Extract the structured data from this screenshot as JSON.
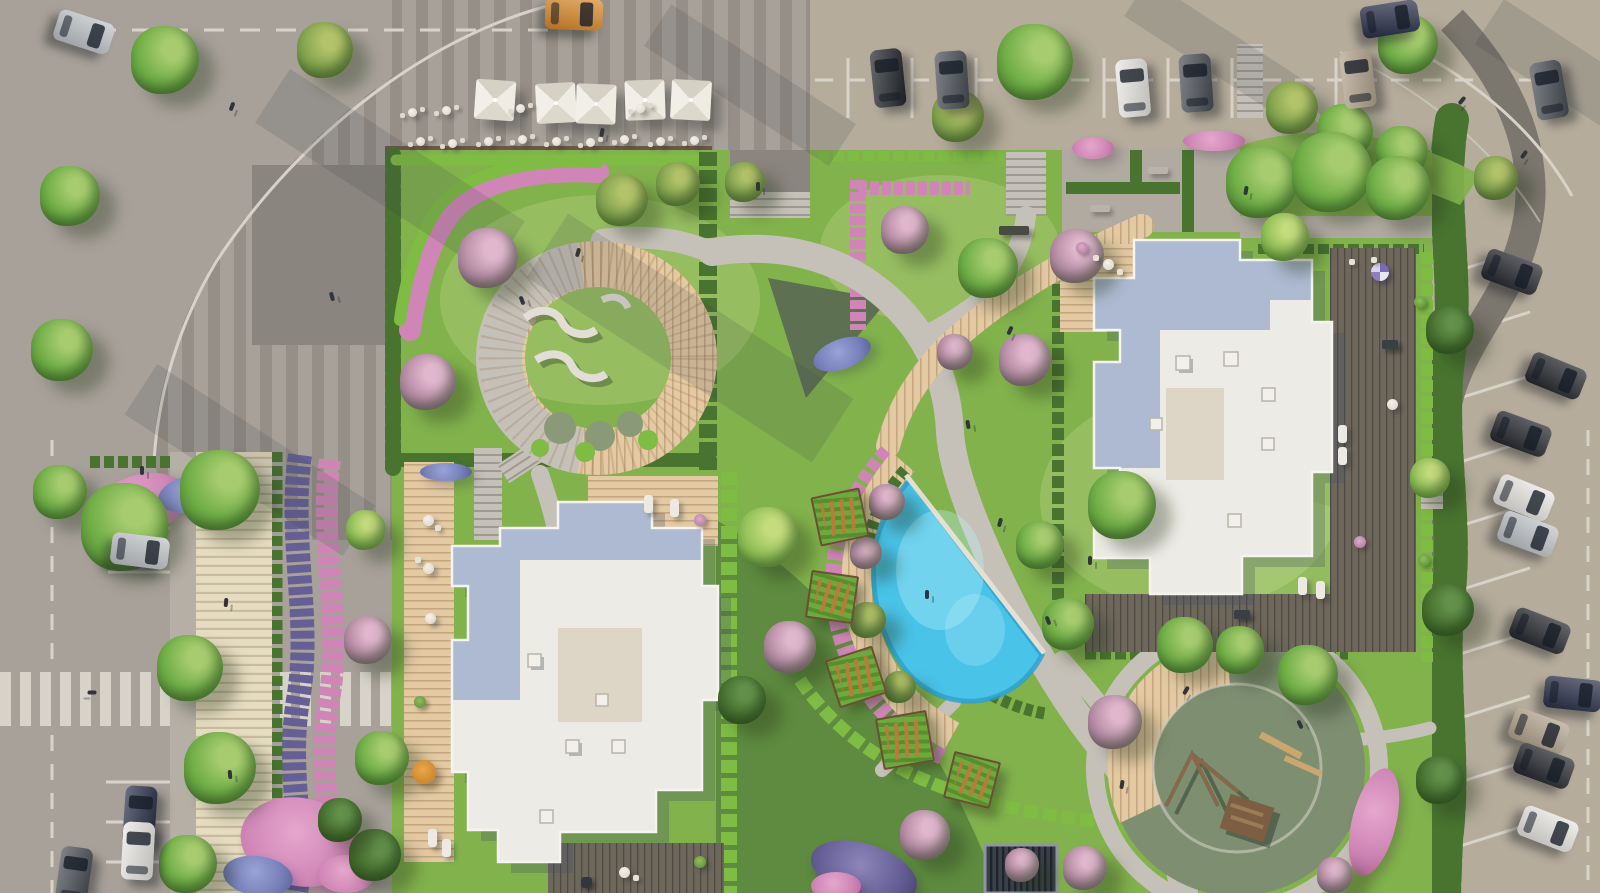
{
  "meta": {
    "view": "aerial-site-plan-render",
    "visible_text": "none"
  },
  "palette": {
    "pave": "#a7a199",
    "paveWarm": "#b5ac9c",
    "stripeDark": "#968f87",
    "squareDark": "#8a857f",
    "asphaltPath": "#7b766e",
    "line": "#d8d3c9",
    "gravel": "#b0aaa1",
    "lawn": "#82b24c",
    "lawnLight": "#95c45d",
    "lawnDark": "#54834a",
    "hedge": "#48742f",
    "hedgeBright": "#7fbc43",
    "pinkFl": "#cf86b6",
    "pinkDeep": "#b3679b",
    "blueFl": "#767fb8",
    "purpleFl": "#655f96",
    "path": "#c6c1b8",
    "pathLight": "#d3cec5",
    "woodLight": "#e3caa3",
    "wood": "#d7bd96",
    "deckDark": "#6e675c",
    "roofWhite": "#edebe5",
    "roofBlue": "#adbad2",
    "roofBeige": "#ddd6c6",
    "poolBlue": "#49c3e8",
    "poolDeep": "#2aa0cf",
    "playSurface": "#7e8e71",
    "treeG": "#6fae46",
    "treeLight": "#a7cc6f",
    "treeDark": "#4a7730",
    "carBlack": "#23262c",
    "carGray": "#494e55",
    "carWhite": "#e8e7e3",
    "carSilver": "#c0c4c8",
    "carNavy": "#283048",
    "carBeige": "#b3a48e",
    "carOrange": "#d98a2b"
  },
  "scene": {
    "trees": [
      {
        "x": 165,
        "y": 60,
        "r": 34
      },
      {
        "x": 70,
        "y": 196,
        "r": 30
      },
      {
        "x": 325,
        "y": 50,
        "r": 28,
        "v": "o"
      },
      {
        "x": 62,
        "y": 350,
        "r": 31
      },
      {
        "x": 60,
        "y": 492,
        "r": 27
      },
      {
        "x": 125,
        "y": 527,
        "r": 44
      },
      {
        "x": 220,
        "y": 490,
        "r": 40
      },
      {
        "x": 190,
        "y": 668,
        "r": 33
      },
      {
        "x": 220,
        "y": 768,
        "r": 36
      },
      {
        "x": 188,
        "y": 864,
        "r": 29
      },
      {
        "x": 1035,
        "y": 62,
        "r": 38
      },
      {
        "x": 958,
        "y": 116,
        "r": 26,
        "v": "o"
      },
      {
        "x": 1408,
        "y": 44,
        "r": 30
      },
      {
        "x": 1292,
        "y": 108,
        "r": 26,
        "v": "o"
      },
      {
        "x": 1345,
        "y": 132,
        "r": 28
      },
      {
        "x": 1402,
        "y": 152,
        "r": 26
      },
      {
        "x": 1496,
        "y": 178,
        "r": 22,
        "v": "o"
      },
      {
        "x": 1450,
        "y": 330,
        "r": 24,
        "v": "d"
      },
      {
        "x": 1448,
        "y": 610,
        "r": 26,
        "v": "d"
      },
      {
        "x": 1440,
        "y": 780,
        "r": 24,
        "v": "d"
      },
      {
        "x": 488,
        "y": 258,
        "r": 30,
        "v": "p"
      },
      {
        "x": 428,
        "y": 382,
        "r": 28,
        "v": "p"
      },
      {
        "x": 622,
        "y": 200,
        "r": 26,
        "v": "o"
      },
      {
        "x": 678,
        "y": 184,
        "r": 22,
        "v": "o"
      },
      {
        "x": 745,
        "y": 182,
        "r": 20,
        "v": "o"
      },
      {
        "x": 905,
        "y": 230,
        "r": 24,
        "v": "p"
      },
      {
        "x": 988,
        "y": 268,
        "r": 30
      },
      {
        "x": 1025,
        "y": 360,
        "r": 26,
        "v": "p"
      },
      {
        "x": 955,
        "y": 352,
        "r": 18,
        "v": "p"
      },
      {
        "x": 1262,
        "y": 182,
        "r": 36
      },
      {
        "x": 1332,
        "y": 172,
        "r": 40
      },
      {
        "x": 1398,
        "y": 188,
        "r": 32
      },
      {
        "x": 1285,
        "y": 237,
        "r": 24,
        "v": "b"
      },
      {
        "x": 1077,
        "y": 256,
        "r": 27,
        "v": "p"
      },
      {
        "x": 1430,
        "y": 478,
        "r": 20,
        "v": "b"
      },
      {
        "x": 887,
        "y": 502,
        "r": 18,
        "v": "p"
      },
      {
        "x": 1040,
        "y": 545,
        "r": 24
      },
      {
        "x": 1068,
        "y": 624,
        "r": 26
      },
      {
        "x": 1122,
        "y": 505,
        "r": 34
      },
      {
        "x": 768,
        "y": 537,
        "r": 30,
        "v": "b"
      },
      {
        "x": 866,
        "y": 553,
        "r": 16,
        "v": "p"
      },
      {
        "x": 868,
        "y": 620,
        "r": 18,
        "v": "o"
      },
      {
        "x": 900,
        "y": 687,
        "r": 16,
        "v": "o"
      },
      {
        "x": 790,
        "y": 647,
        "r": 26,
        "v": "p"
      },
      {
        "x": 742,
        "y": 700,
        "r": 24,
        "v": "d"
      },
      {
        "x": 925,
        "y": 835,
        "r": 25,
        "v": "p"
      },
      {
        "x": 1022,
        "y": 865,
        "r": 17,
        "v": "p"
      },
      {
        "x": 1185,
        "y": 645,
        "r": 28
      },
      {
        "x": 1240,
        "y": 650,
        "r": 24
      },
      {
        "x": 1308,
        "y": 675,
        "r": 30
      },
      {
        "x": 1115,
        "y": 722,
        "r": 27,
        "v": "p"
      },
      {
        "x": 1085,
        "y": 868,
        "r": 22,
        "v": "p"
      },
      {
        "x": 1335,
        "y": 875,
        "r": 18,
        "v": "p"
      },
      {
        "x": 368,
        "y": 640,
        "r": 24,
        "v": "p"
      },
      {
        "x": 382,
        "y": 758,
        "r": 27
      },
      {
        "x": 366,
        "y": 530,
        "r": 20,
        "v": "b"
      },
      {
        "x": 375,
        "y": 855,
        "r": 26,
        "v": "d"
      },
      {
        "x": 340,
        "y": 820,
        "r": 22,
        "v": "d"
      }
    ],
    "cars": [
      {
        "x": 84,
        "y": 32,
        "rot": 108,
        "color": "carSilver"
      },
      {
        "x": 574,
        "y": 14,
        "rot": 92,
        "color": "carOrange"
      },
      {
        "x": 888,
        "y": 78,
        "rot": -6,
        "color": "carBlack"
      },
      {
        "x": 952,
        "y": 80,
        "rot": -4,
        "color": "carGray"
      },
      {
        "x": 1133,
        "y": 88,
        "rot": -5,
        "color": "carWhite"
      },
      {
        "x": 1196,
        "y": 83,
        "rot": -4,
        "color": "carGray"
      },
      {
        "x": 1390,
        "y": 19,
        "rot": 81,
        "color": "carNavy"
      },
      {
        "x": 1358,
        "y": 79,
        "rot": -7,
        "color": "carBeige"
      },
      {
        "x": 1549,
        "y": 90,
        "rot": -10,
        "color": "carGray"
      },
      {
        "x": 1512,
        "y": 272,
        "rot": 110,
        "color": "carBlack"
      },
      {
        "x": 1556,
        "y": 376,
        "rot": 112,
        "color": "carBlack"
      },
      {
        "x": 1521,
        "y": 434,
        "rot": 110,
        "color": "carBlack"
      },
      {
        "x": 1524,
        "y": 498,
        "rot": 112,
        "color": "carWhite"
      },
      {
        "x": 1528,
        "y": 534,
        "rot": 110,
        "color": "carSilver"
      },
      {
        "x": 1540,
        "y": 631,
        "rot": 111,
        "color": "carBlack"
      },
      {
        "x": 1573,
        "y": 694,
        "rot": 96,
        "color": "carNavy"
      },
      {
        "x": 1539,
        "y": 731,
        "rot": 110,
        "color": "carBeige"
      },
      {
        "x": 1544,
        "y": 766,
        "rot": 110,
        "color": "carBlack"
      },
      {
        "x": 1548,
        "y": 829,
        "rot": 111,
        "color": "carWhite"
      },
      {
        "x": 140,
        "y": 551,
        "rot": 97,
        "color": "carSilver"
      },
      {
        "x": 140,
        "y": 815,
        "rot": 4,
        "color": "carNavy"
      },
      {
        "x": 138,
        "y": 851,
        "rot": 3,
        "color": "carWhite"
      },
      {
        "x": 74,
        "y": 876,
        "rot": 8,
        "color": "carGray"
      }
    ],
    "umbrellas": [
      [
        495,
        100,
        4
      ],
      [
        556,
        103,
        -3
      ],
      [
        596,
        104,
        2
      ],
      [
        645,
        100,
        -2
      ],
      [
        691,
        100,
        3
      ]
    ],
    "cafe_tables": [
      [
        412,
        112
      ],
      [
        446,
        110
      ],
      [
        420,
        141
      ],
      [
        452,
        143
      ],
      [
        488,
        141
      ],
      [
        522,
        139
      ],
      [
        556,
        141
      ],
      [
        590,
        142
      ],
      [
        624,
        139
      ],
      [
        660,
        141
      ],
      [
        694,
        140
      ],
      [
        520,
        108
      ],
      [
        640,
        108
      ]
    ],
    "pergolas": [
      {
        "x": 838,
        "y": 515,
        "s": 46,
        "rot": -12
      },
      {
        "x": 830,
        "y": 595,
        "s": 44,
        "rot": 8
      },
      {
        "x": 854,
        "y": 675,
        "s": 46,
        "rot": -18
      },
      {
        "x": 903,
        "y": 738,
        "s": 48,
        "rot": -10
      },
      {
        "x": 970,
        "y": 778,
        "s": 44,
        "rot": 14
      }
    ],
    "furniture": [
      {
        "t": "ball",
        "x": 1380,
        "y": 272
      },
      {
        "t": "chair",
        "x": 1352,
        "y": 262
      },
      {
        "t": "chair",
        "x": 1374,
        "y": 260
      },
      {
        "t": "tableDark",
        "x": 1390,
        "y": 344
      },
      {
        "t": "lounger",
        "x": 1342,
        "y": 434
      },
      {
        "t": "lounger",
        "x": 1342,
        "y": 456
      },
      {
        "t": "tableRound",
        "x": 1392,
        "y": 404
      },
      {
        "t": "plant",
        "x": 1420,
        "y": 302
      },
      {
        "t": "plant",
        "x": 1424,
        "y": 560
      },
      {
        "t": "lounger",
        "x": 1302,
        "y": 586
      },
      {
        "t": "lounger",
        "x": 1320,
        "y": 590
      },
      {
        "t": "tableDark",
        "x": 1242,
        "y": 614
      },
      {
        "t": "plantPink",
        "x": 1360,
        "y": 542
      },
      {
        "t": "tableRound",
        "x": 1108,
        "y": 264
      },
      {
        "t": "chair",
        "x": 1120,
        "y": 272
      },
      {
        "t": "chair",
        "x": 1096,
        "y": 258
      },
      {
        "t": "plantPink",
        "x": 1082,
        "y": 248
      },
      {
        "t": "tableRound",
        "x": 428,
        "y": 520
      },
      {
        "t": "chair",
        "x": 438,
        "y": 528
      },
      {
        "t": "tableRound",
        "x": 428,
        "y": 568
      },
      {
        "t": "chair",
        "x": 418,
        "y": 560
      },
      {
        "t": "tableRound",
        "x": 430,
        "y": 618
      },
      {
        "t": "umbOrange",
        "x": 424,
        "y": 772
      },
      {
        "t": "lounger",
        "x": 432,
        "y": 838
      },
      {
        "t": "lounger",
        "x": 446,
        "y": 848
      },
      {
        "t": "plant",
        "x": 420,
        "y": 702
      },
      {
        "t": "lounger",
        "x": 648,
        "y": 504
      },
      {
        "t": "lounger",
        "x": 674,
        "y": 508
      },
      {
        "t": "plantPink",
        "x": 700,
        "y": 520
      },
      {
        "t": "tableRound",
        "x": 624,
        "y": 872
      },
      {
        "t": "chair",
        "x": 636,
        "y": 878
      },
      {
        "t": "grill",
        "x": 586,
        "y": 882
      },
      {
        "t": "plant",
        "x": 700,
        "y": 862
      },
      {
        "t": "bench",
        "x": 1100,
        "y": 208
      },
      {
        "t": "bench",
        "x": 1158,
        "y": 170
      },
      {
        "t": "benchDark",
        "x": 1014,
        "y": 230
      }
    ],
    "flower_beds": [
      {
        "c": "pink",
        "x": 140,
        "y": 505,
        "w": 96,
        "h": 60,
        "r": -18
      },
      {
        "c": "blue",
        "x": 190,
        "y": 494,
        "w": 64,
        "h": 36,
        "r": -12
      },
      {
        "c": "pink",
        "x": 300,
        "y": 842,
        "w": 120,
        "h": 88,
        "r": 12
      },
      {
        "c": "blue",
        "x": 258,
        "y": 876,
        "w": 70,
        "h": 40,
        "r": 8
      },
      {
        "c": "pink",
        "x": 346,
        "y": 874,
        "w": 58,
        "h": 38,
        "r": 0
      },
      {
        "c": "purple",
        "x": 864,
        "y": 872,
        "w": 110,
        "h": 56,
        "r": 18
      },
      {
        "c": "pink",
        "x": 836,
        "y": 886,
        "w": 50,
        "h": 28,
        "r": 0
      },
      {
        "c": "pink",
        "x": 1093,
        "y": 148,
        "w": 42,
        "h": 22,
        "r": 0
      },
      {
        "c": "pink",
        "x": 1214,
        "y": 141,
        "w": 62,
        "h": 20,
        "r": 0
      },
      {
        "c": "pink",
        "x": 1374,
        "y": 822,
        "w": 44,
        "h": 110,
        "r": 14
      },
      {
        "c": "blue",
        "x": 842,
        "y": 354,
        "w": 60,
        "h": 30,
        "r": -20
      },
      {
        "c": "blue",
        "x": 446,
        "y": 472,
        "w": 52,
        "h": 18,
        "r": 0
      }
    ],
    "people": [
      [
        232,
        106,
        20
      ],
      [
        332,
        296,
        -15
      ],
      [
        142,
        470,
        0
      ],
      [
        602,
        132,
        10
      ],
      [
        522,
        300,
        -20
      ],
      [
        578,
        252,
        15
      ],
      [
        758,
        186,
        0
      ],
      [
        1010,
        330,
        25
      ],
      [
        968,
        424,
        -10
      ],
      [
        1000,
        522,
        15
      ],
      [
        1048,
        620,
        -20
      ],
      [
        1122,
        784,
        10
      ],
      [
        927,
        594,
        0
      ],
      [
        1186,
        690,
        30
      ],
      [
        1300,
        724,
        -25
      ],
      [
        1462,
        100,
        40
      ],
      [
        1524,
        154,
        35
      ],
      [
        226,
        602,
        5
      ],
      [
        230,
        774,
        -5
      ],
      [
        92,
        692,
        90
      ],
      [
        1246,
        190,
        10
      ],
      [
        1090,
        560,
        0
      ]
    ]
  }
}
